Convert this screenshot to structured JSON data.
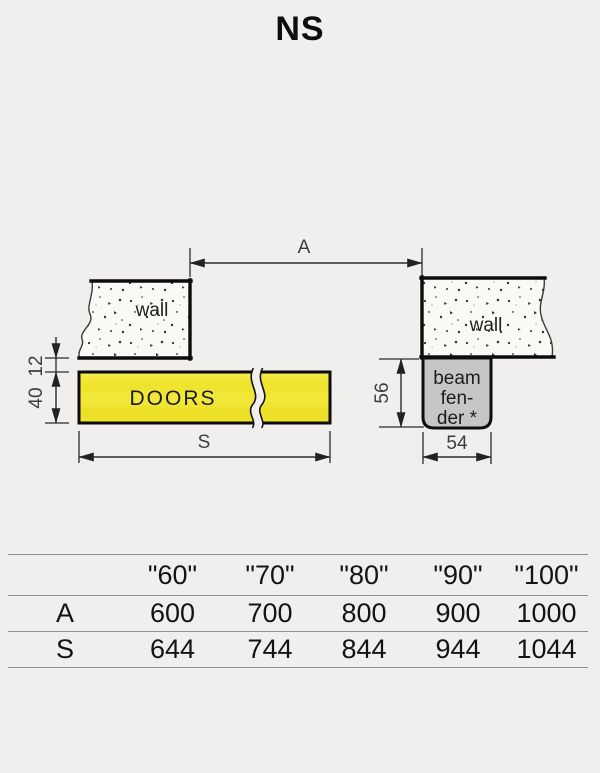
{
  "title": "NS",
  "diagram": {
    "dim_a_label": "A",
    "dim_s_label": "S",
    "dim_gap_label": "12",
    "dim_door_height_label": "40",
    "dim_fender_height_label": "56",
    "dim_fender_width_label": "54",
    "wall_left_label": "wall",
    "wall_right_label": "wall",
    "doors_label": "DOORS",
    "beam_fender": {
      "line1": "beam",
      "line2": "fen-",
      "line3": "der *"
    },
    "colors": {
      "background": "#f0efed",
      "door_yellow": "#f0e431",
      "fender_gray": "#c6c6c5",
      "line_black": "#0c0c0c",
      "dim_gray": "#3d3d3d"
    }
  },
  "table": {
    "columns": [
      "\"60\"",
      "\"70\"",
      "\"80\"",
      "\"90\"",
      "\"100\""
    ],
    "rows": [
      {
        "label": "A",
        "values": [
          "600",
          "700",
          "800",
          "900",
          "1000"
        ]
      },
      {
        "label": "S",
        "values": [
          "644",
          "744",
          "844",
          "944",
          "1044"
        ]
      }
    ]
  }
}
